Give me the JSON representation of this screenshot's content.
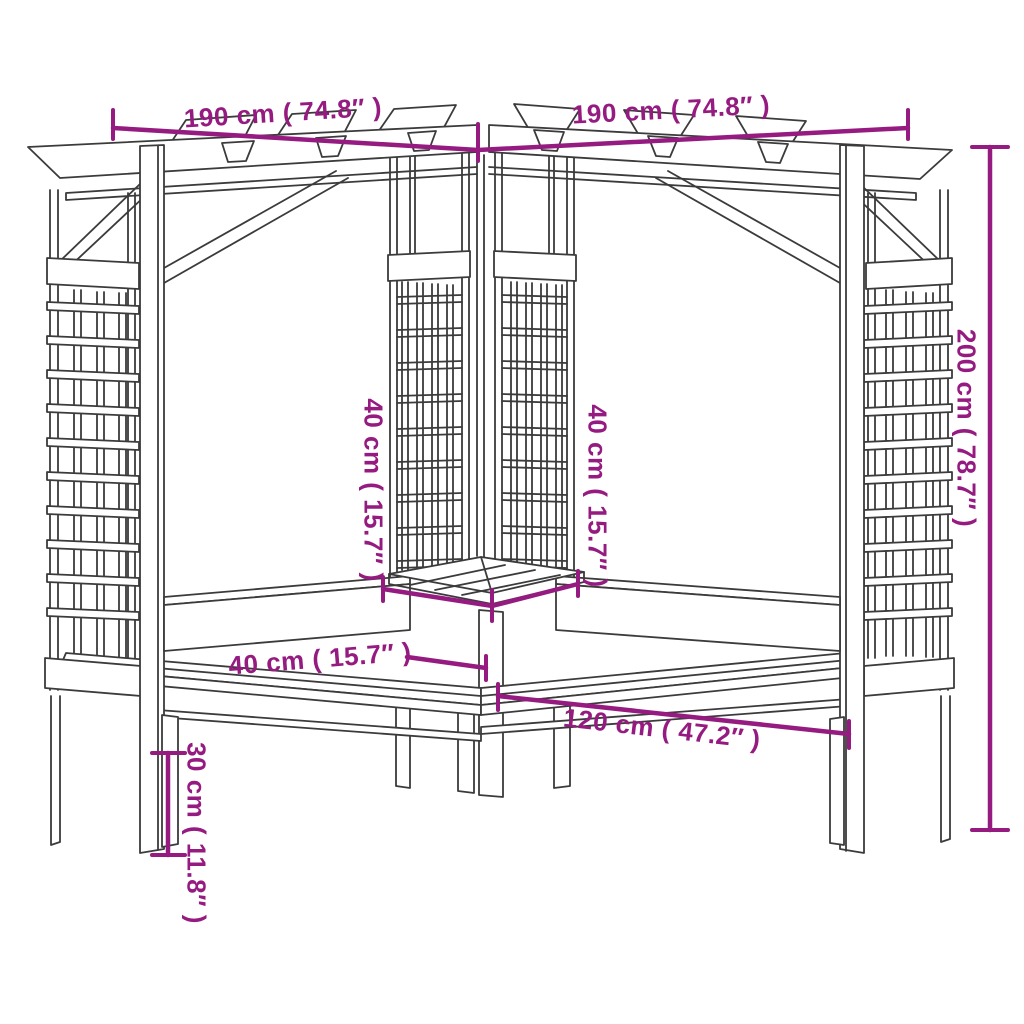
{
  "diagram": {
    "title": "Corner pergola with benches and trellis — dimension diagram",
    "colors": {
      "dimension_accent": "#951b81",
      "line_art": "#3b3b3b",
      "background": "#ffffff"
    },
    "dimensions": {
      "top_left_width": "190 cm ( 74.8″ )",
      "top_right_width": "190 cm ( 74.8″ )",
      "total_height": "200 cm ( 78.7″ )",
      "center_left_trellis_width": "40 cm ( 15.7″ )",
      "center_right_trellis_width": "40 cm ( 15.7″ )",
      "bench_depth": "40 cm ( 15.7″ )",
      "bench_length": "120 cm ( 47.2″ )",
      "bench_seat_height": "30 cm ( 11.8″ )"
    }
  }
}
